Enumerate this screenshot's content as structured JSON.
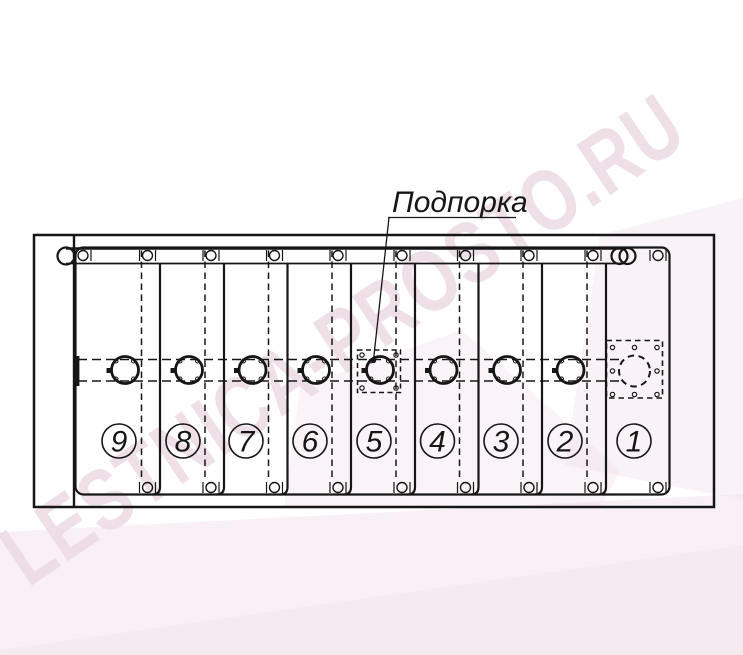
{
  "drawing": {
    "callout_label": "Подпорка",
    "watermark_text": "LESTNICA-PROSTO.RU",
    "steps": [
      {
        "number": "9"
      },
      {
        "number": "8"
      },
      {
        "number": "7"
      },
      {
        "number": "6"
      },
      {
        "number": "5"
      },
      {
        "number": "4"
      },
      {
        "number": "3"
      },
      {
        "number": "2"
      },
      {
        "number": "1"
      }
    ],
    "colors": {
      "line": "#161616",
      "watermark_letters": "#ecd9e3",
      "watermark_wedge": "#f2e2eb",
      "background": "#ffffff"
    }
  }
}
